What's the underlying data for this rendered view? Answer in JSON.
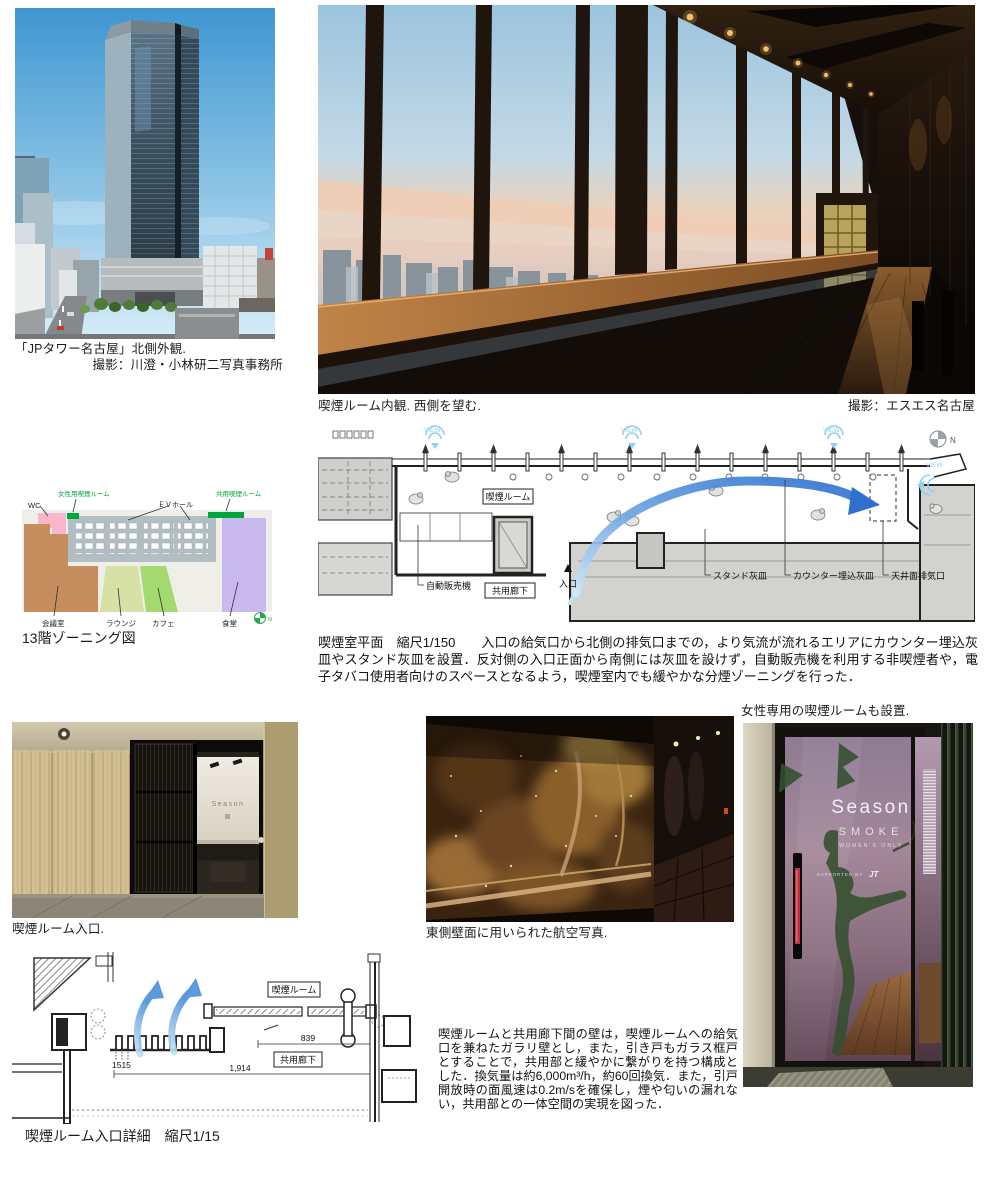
{
  "tower": {
    "caption": "「JPタワー名古屋」北側外観.",
    "credit": "撮影：川澄・小林研二写真事務所"
  },
  "interior": {
    "caption": "喫煙ルーム内観. 西側を望む.",
    "credit": "撮影：エスエス名古屋"
  },
  "zoning": {
    "title": "13階ゾーニング図",
    "wc": "WC",
    "womens_room": "女性用喫煙ルーム",
    "ev_hall": "ＥＶホール",
    "shared_room": "共用喫煙ルーム",
    "meeting": "会議室",
    "lounge": "ラウンジ",
    "cafe": "カフェ",
    "dining": "食堂",
    "north": "N",
    "colors": {
      "wc": "#f7b6cb",
      "meeting": "#c68d5f",
      "lounge": "#d7e0a5",
      "cafe": "#a3d96f",
      "dining": "#cab9ee",
      "core": "#b2bec2",
      "smoking_green": "#00a63c"
    }
  },
  "plan": {
    "room": "喫煙ルーム",
    "corridor": "共用廊下",
    "vending": "自動販売機",
    "entrance": "入口",
    "stand_ashtray": "スタンド灰皿",
    "counter_ashtray": "カウンター埋込灰皿",
    "exhaust": "天井面排気口",
    "view": "VIEW",
    "north": "N",
    "caption_title": "喫煙室平面　縮尺1/150",
    "description": "入口の給気口から北側の排気口までの，より気流が流れるエリアにカウンター埋込灰皿やスタンド灰皿を設置．反対側の入口正面から南側には灰皿を設けず，自動販売機を利用する非喫煙者や，電子タバコ使用者向けのスペースとなるよう，喫煙室内でも緩やかな分煙ゾーニングを行った．",
    "arrow_color": "#2f6fce",
    "view_color": "#7fd0ee"
  },
  "womens": {
    "caption": "女性専用の喫煙ルームも設置.",
    "sign_brand": "Season",
    "sign_sub": "SMOKE",
    "sign_note": "WOMEN'S ONLY",
    "sign_support": "SUPPORTED BY",
    "sign_jt": "JT"
  },
  "entrance_photo": {
    "caption": "喫煙ルーム入口.",
    "sign": "Season"
  },
  "aerial": {
    "caption": "東側壁面に用いられた航空写真."
  },
  "detail": {
    "caption": "喫煙ルーム入口詳細　縮尺1/15",
    "room": "喫煙ルーム",
    "corridor": "共用廊下",
    "dim_louver": "1515",
    "dim_door": "839",
    "dim_total": "1,914"
  },
  "wall_text": "喫煙ルームと共用廊下間の壁は，喫煙ルームへの給気口を兼ねたガラリ壁とし，また，引き戸もガラス框戸とすることで，共用部と緩やかに繋がりを持つ構成とした．換気量は約6,000m³/h，約60回換気．また，引戸開放時の面風速は0.2m/sを確保し，煙や匂いの漏れない，共用部との一体空間の実現を図った．"
}
